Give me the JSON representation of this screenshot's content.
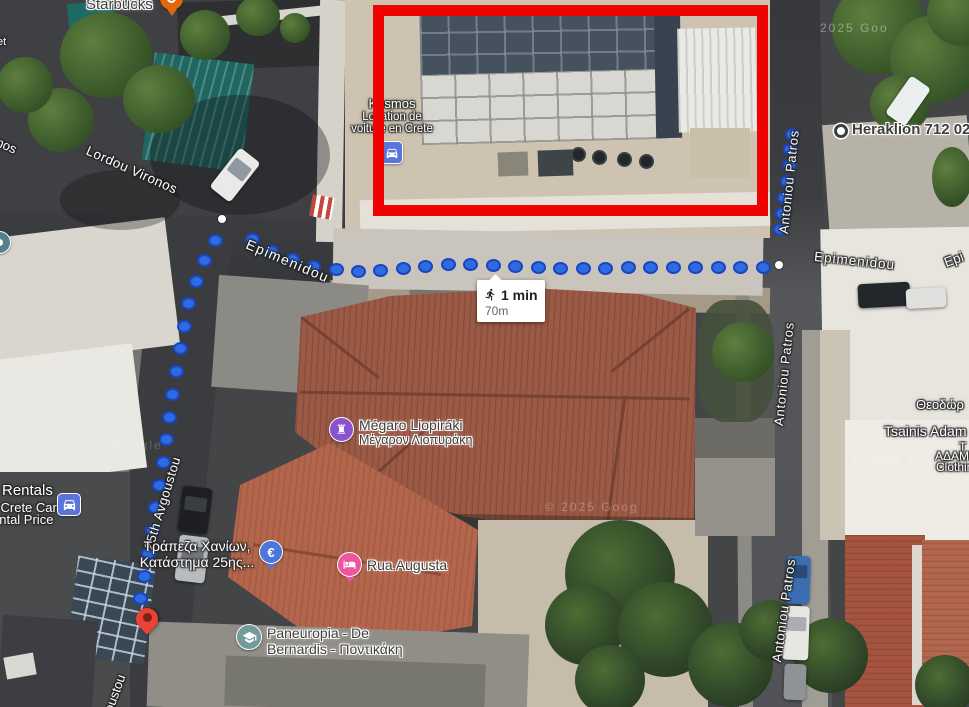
{
  "map_type": "satellite",
  "route": {
    "mode": "walking",
    "duration": "1 min",
    "distance": "70m",
    "dot_fill": "#2e6ae0",
    "dot_border": "#1b45c0",
    "dot_spacing": [
      16,
      22.5,
      23
    ],
    "polylines": [
      [
        [
          792,
          134
        ],
        [
          789,
          168
        ],
        [
          784,
          204
        ],
        [
          779,
          244
        ]
      ],
      [
        [
          763,
          267
        ],
        [
          700,
          267
        ],
        [
          620,
          268
        ],
        [
          540,
          268
        ],
        [
          455,
          264
        ],
        [
          365,
          272
        ],
        [
          320,
          268
        ],
        [
          282,
          257
        ],
        [
          241,
          233
        ]
      ],
      [
        [
          215,
          240
        ],
        [
          204,
          262
        ],
        [
          195,
          285
        ],
        [
          187,
          310
        ],
        [
          182,
          338
        ],
        [
          177,
          368
        ],
        [
          172,
          398
        ],
        [
          168,
          430
        ],
        [
          163,
          463
        ],
        [
          157,
          500
        ],
        [
          152,
          532
        ],
        [
          147,
          560
        ],
        [
          142,
          590
        ],
        [
          137,
          614
        ]
      ]
    ],
    "white_dots": [
      [
        779,
        265
      ],
      [
        222,
        219
      ]
    ],
    "pin": {
      "x": 148,
      "y": 634,
      "color": "#ea4335"
    }
  },
  "streets": {
    "lordou_vironos": "Lordou Vironos",
    "vironos_fragment": "nos",
    "epimenidou_west": "Epimenidou",
    "epimenidou_east": "Epimenidou",
    "epimenidou_fragment": "Epi",
    "antoniou_patros_top": "Antoniou Patros",
    "antoniou_patros_mid": "Antoniou Patros",
    "antoniou_patros_bottom": "Antoniou Patros",
    "avgoustou": "25th Avgoustou",
    "avgoustou_fragment": "oustou"
  },
  "pois": {
    "starbucks": {
      "label": "Starbucks",
      "pin_color": "#e4660a"
    },
    "heraklion": {
      "label": "Heraklion 712 02"
    },
    "kosmos": {
      "line1": "Kosmos",
      "line2": "Location de",
      "line3": "voiture en Crete",
      "icon_color": "#5b74d9"
    },
    "megaro": {
      "line1": "Mégaro Liopiráki",
      "line2": "Μέγαρον Λιοπυράκη",
      "icon_color": "#8a52cc"
    },
    "rua_augusta": {
      "label": "Rua Augusta",
      "icon_color": "#ee559e"
    },
    "paneuropia": {
      "line1": "Paneuropia - De",
      "line2": "Bernardis - Ποντικάκη",
      "icon_color": "#739a9c"
    },
    "bank": {
      "line1": "Τράπεζα Χανίων,",
      "line2": "Κατάστημα 25ης...",
      "icon_color": "#4d76dd",
      "icon_glyph": "€"
    },
    "rentals": {
      "line1": "Rentals",
      "line2": "l Crete Car",
      "line3": "ental Price",
      "icon_color": "#5b74d9"
    },
    "tsainis": {
      "line1": "Θεοδώρ",
      "line2": "Tsainis Adam",
      "line3": "T",
      "line4": "ΑΔΑΜ",
      "line5": "Clothin"
    },
    "edge_fragment": "et"
  },
  "annotations": {
    "highlight_box_color": "#ee0000"
  },
  "watermarks": {
    "top_right": "2025 Goo",
    "roof": "© 2025 Goog",
    "right": "© 2025 G",
    "left": "Google"
  }
}
